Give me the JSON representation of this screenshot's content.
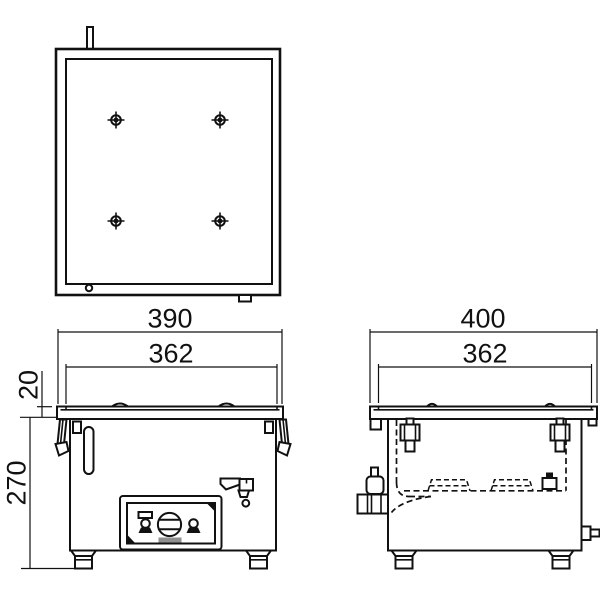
{
  "drawing": {
    "type": "engineering-three-view",
    "colors": {
      "line": "#111111",
      "background": "#ffffff",
      "panel_slot_gray": "#8f8f8f"
    },
    "top_view": {
      "hole_diameter_label": "φ10",
      "hole_pitch_horizontal": "170",
      "hole_pitch_vertical": "170"
    },
    "front_view": {
      "overall_width": "390",
      "opening_width": "362",
      "lid_height": "20",
      "body_height": "270"
    },
    "side_view": {
      "overall_depth": "400",
      "opening_depth": "362"
    }
  }
}
